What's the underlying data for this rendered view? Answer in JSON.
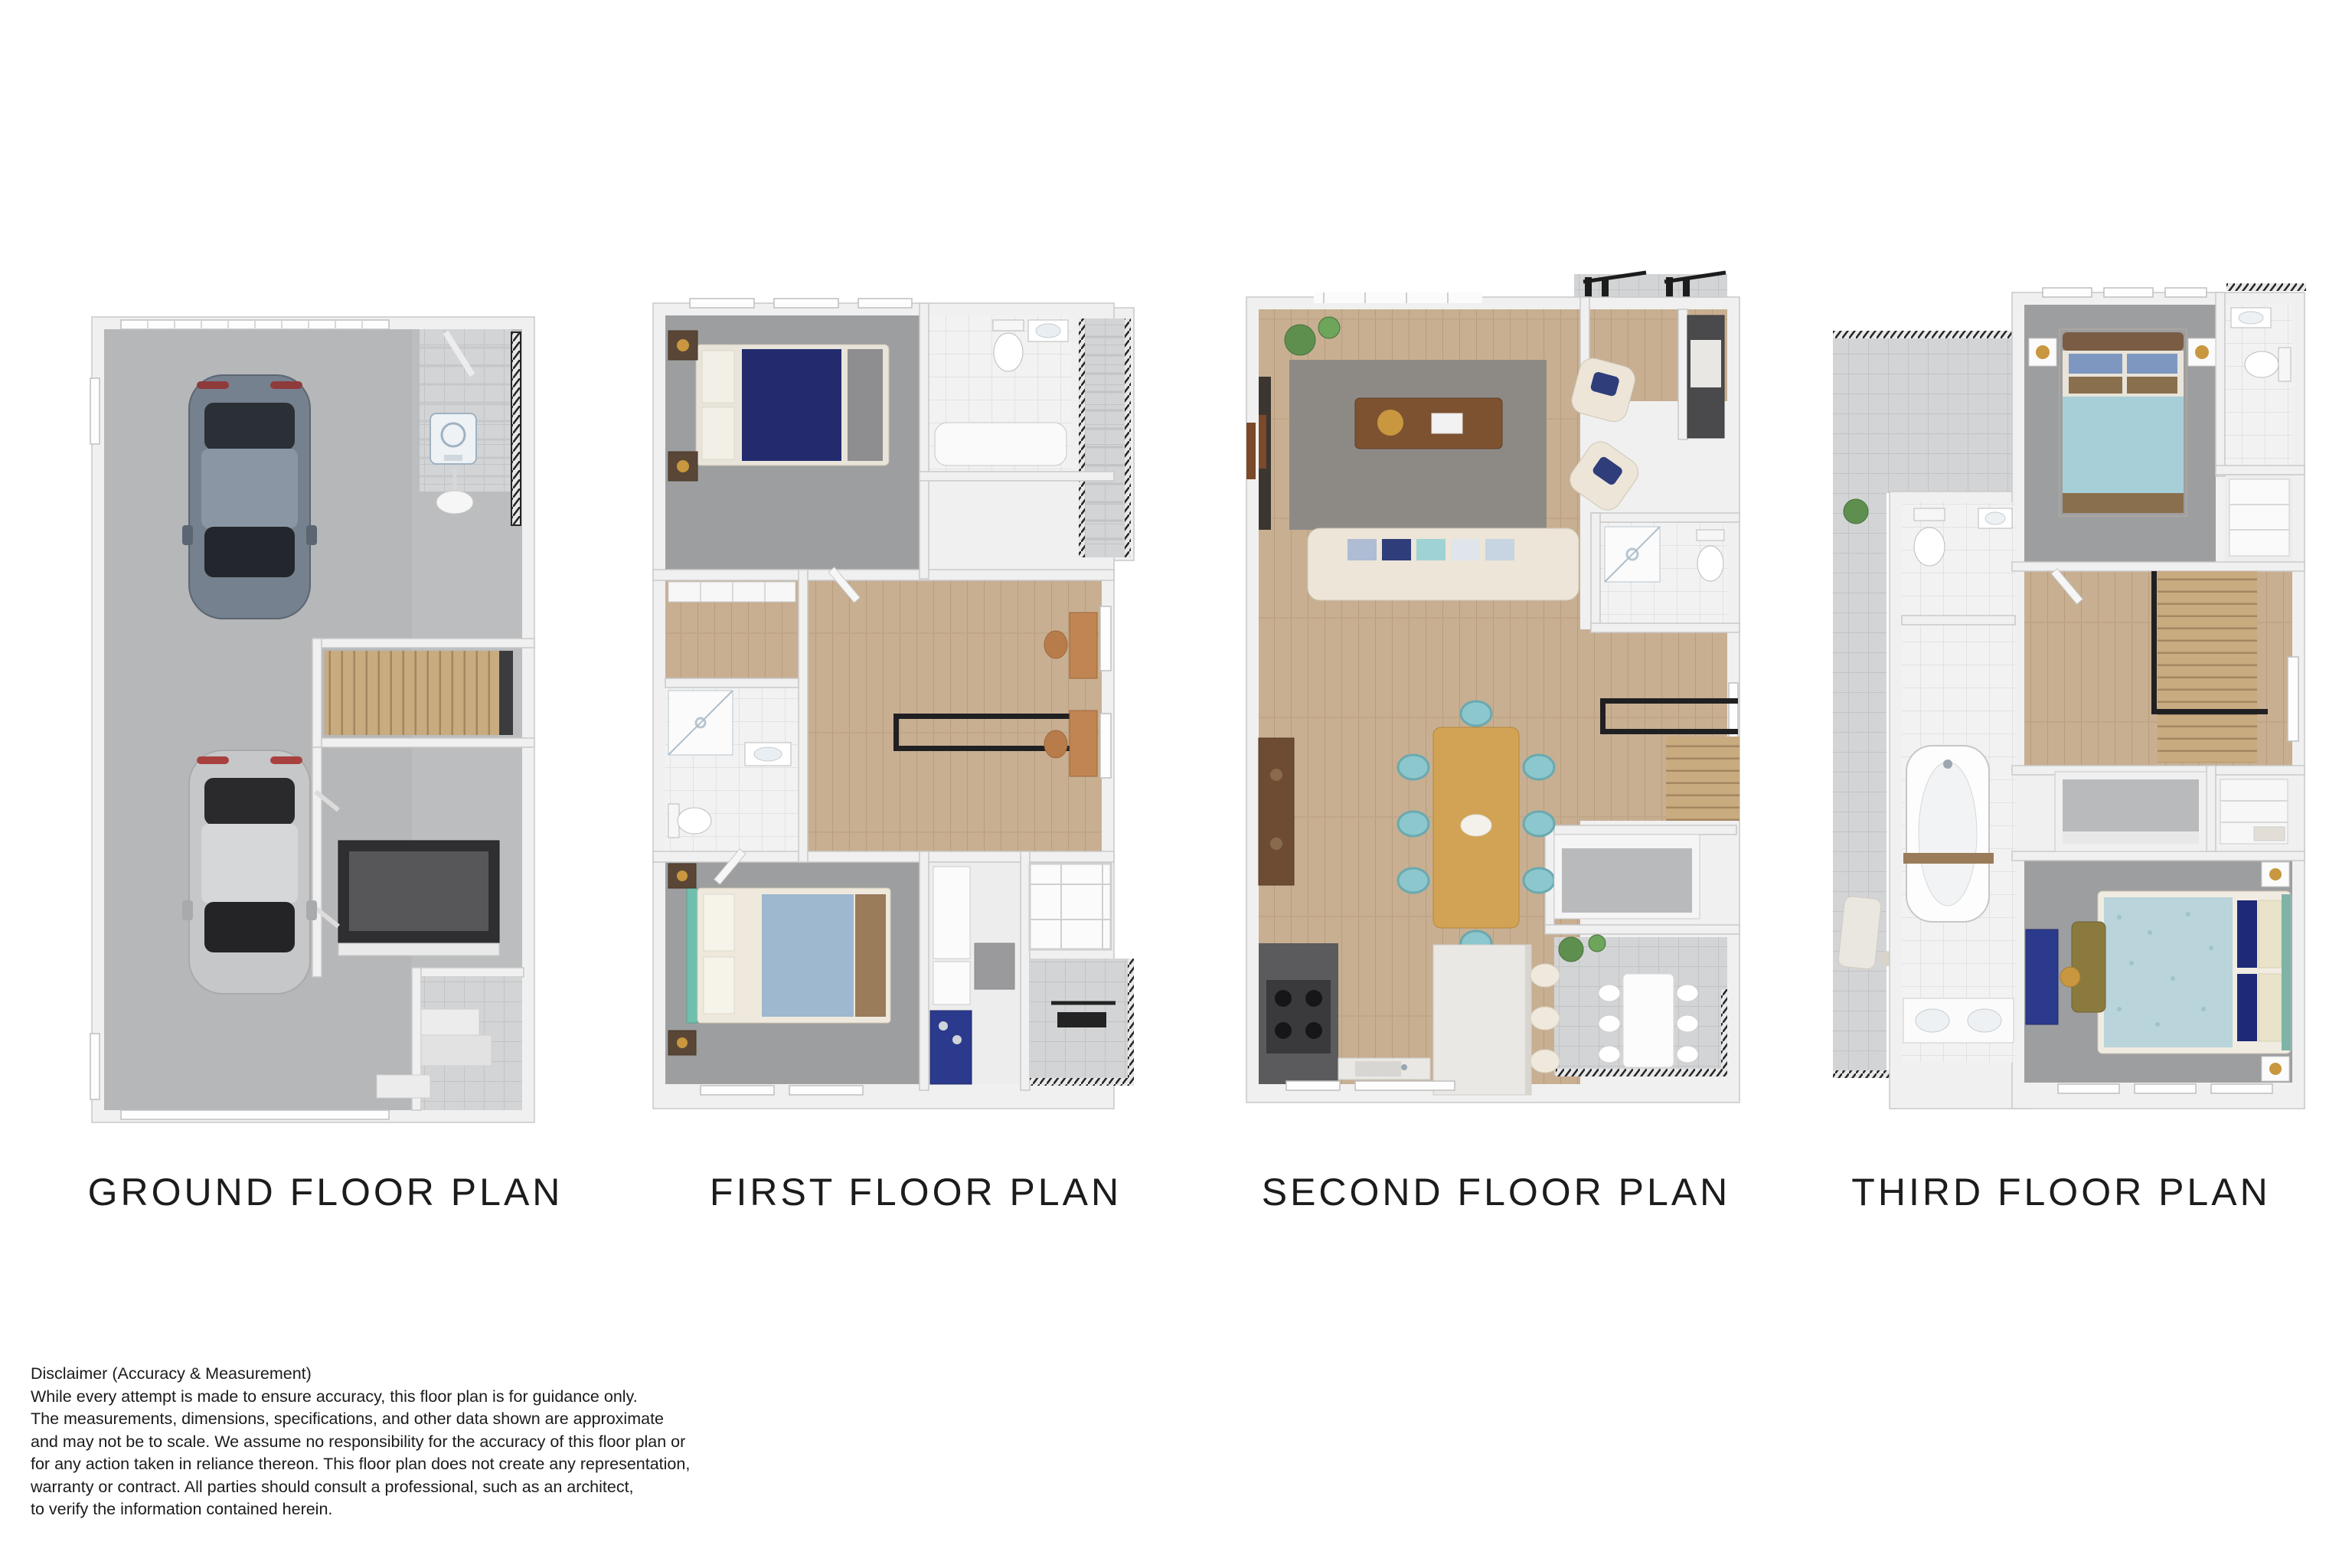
{
  "palette": {
    "background": "#ffffff",
    "title_color": "#1c1c1c",
    "text_color": "#1b1b1b",
    "wall": "#f0f0f0",
    "wall_edge": "#c9c9c9",
    "floor_concrete": "#b6b7b9",
    "floor_tile_gray": "#d3d4d6",
    "floor_tile_white": "#f2f2f2",
    "floor_carpet": "#9d9ea0",
    "floor_wood": "#c8af92",
    "stair_tread_wood": "#c9ab80",
    "railing_black": "#262626",
    "accent_navy": "#232b6e",
    "accent_teal_chair": "#8cc7cd",
    "accent_light_blue": "#a7cfd8",
    "sofa_cream": "#ece5d8",
    "dining_table_wood": "#d2a354",
    "marble": "#eae8e4",
    "car_blue_gray": "#75818e",
    "car_silver": "#c6c7c9",
    "plant_green": "#5e8f4e"
  },
  "plans": [
    {
      "id": "ground",
      "title": "GROUND FLOOR PLAN"
    },
    {
      "id": "first",
      "title": "FIRST FLOOR PLAN"
    },
    {
      "id": "second",
      "title": "SECOND FLOOR PLAN"
    },
    {
      "id": "third",
      "title": "THIRD FLOOR PLAN"
    }
  ],
  "disclaimer": {
    "heading": "Disclaimer (Accuracy & Measurement)",
    "lines": [
      "While every attempt is made to ensure accuracy, this floor plan is for guidance only.",
      "The measurements, dimensions, specifications, and other data shown are approximate",
      "and may not be to scale. We assume no responsibility for the accuracy of this floor plan or",
      "for any action taken in reliance thereon. This floor plan does not create any representation,",
      "warranty or contract. All parties should consult a professional, such as an architect,",
      "to verify the information contained herein."
    ]
  }
}
